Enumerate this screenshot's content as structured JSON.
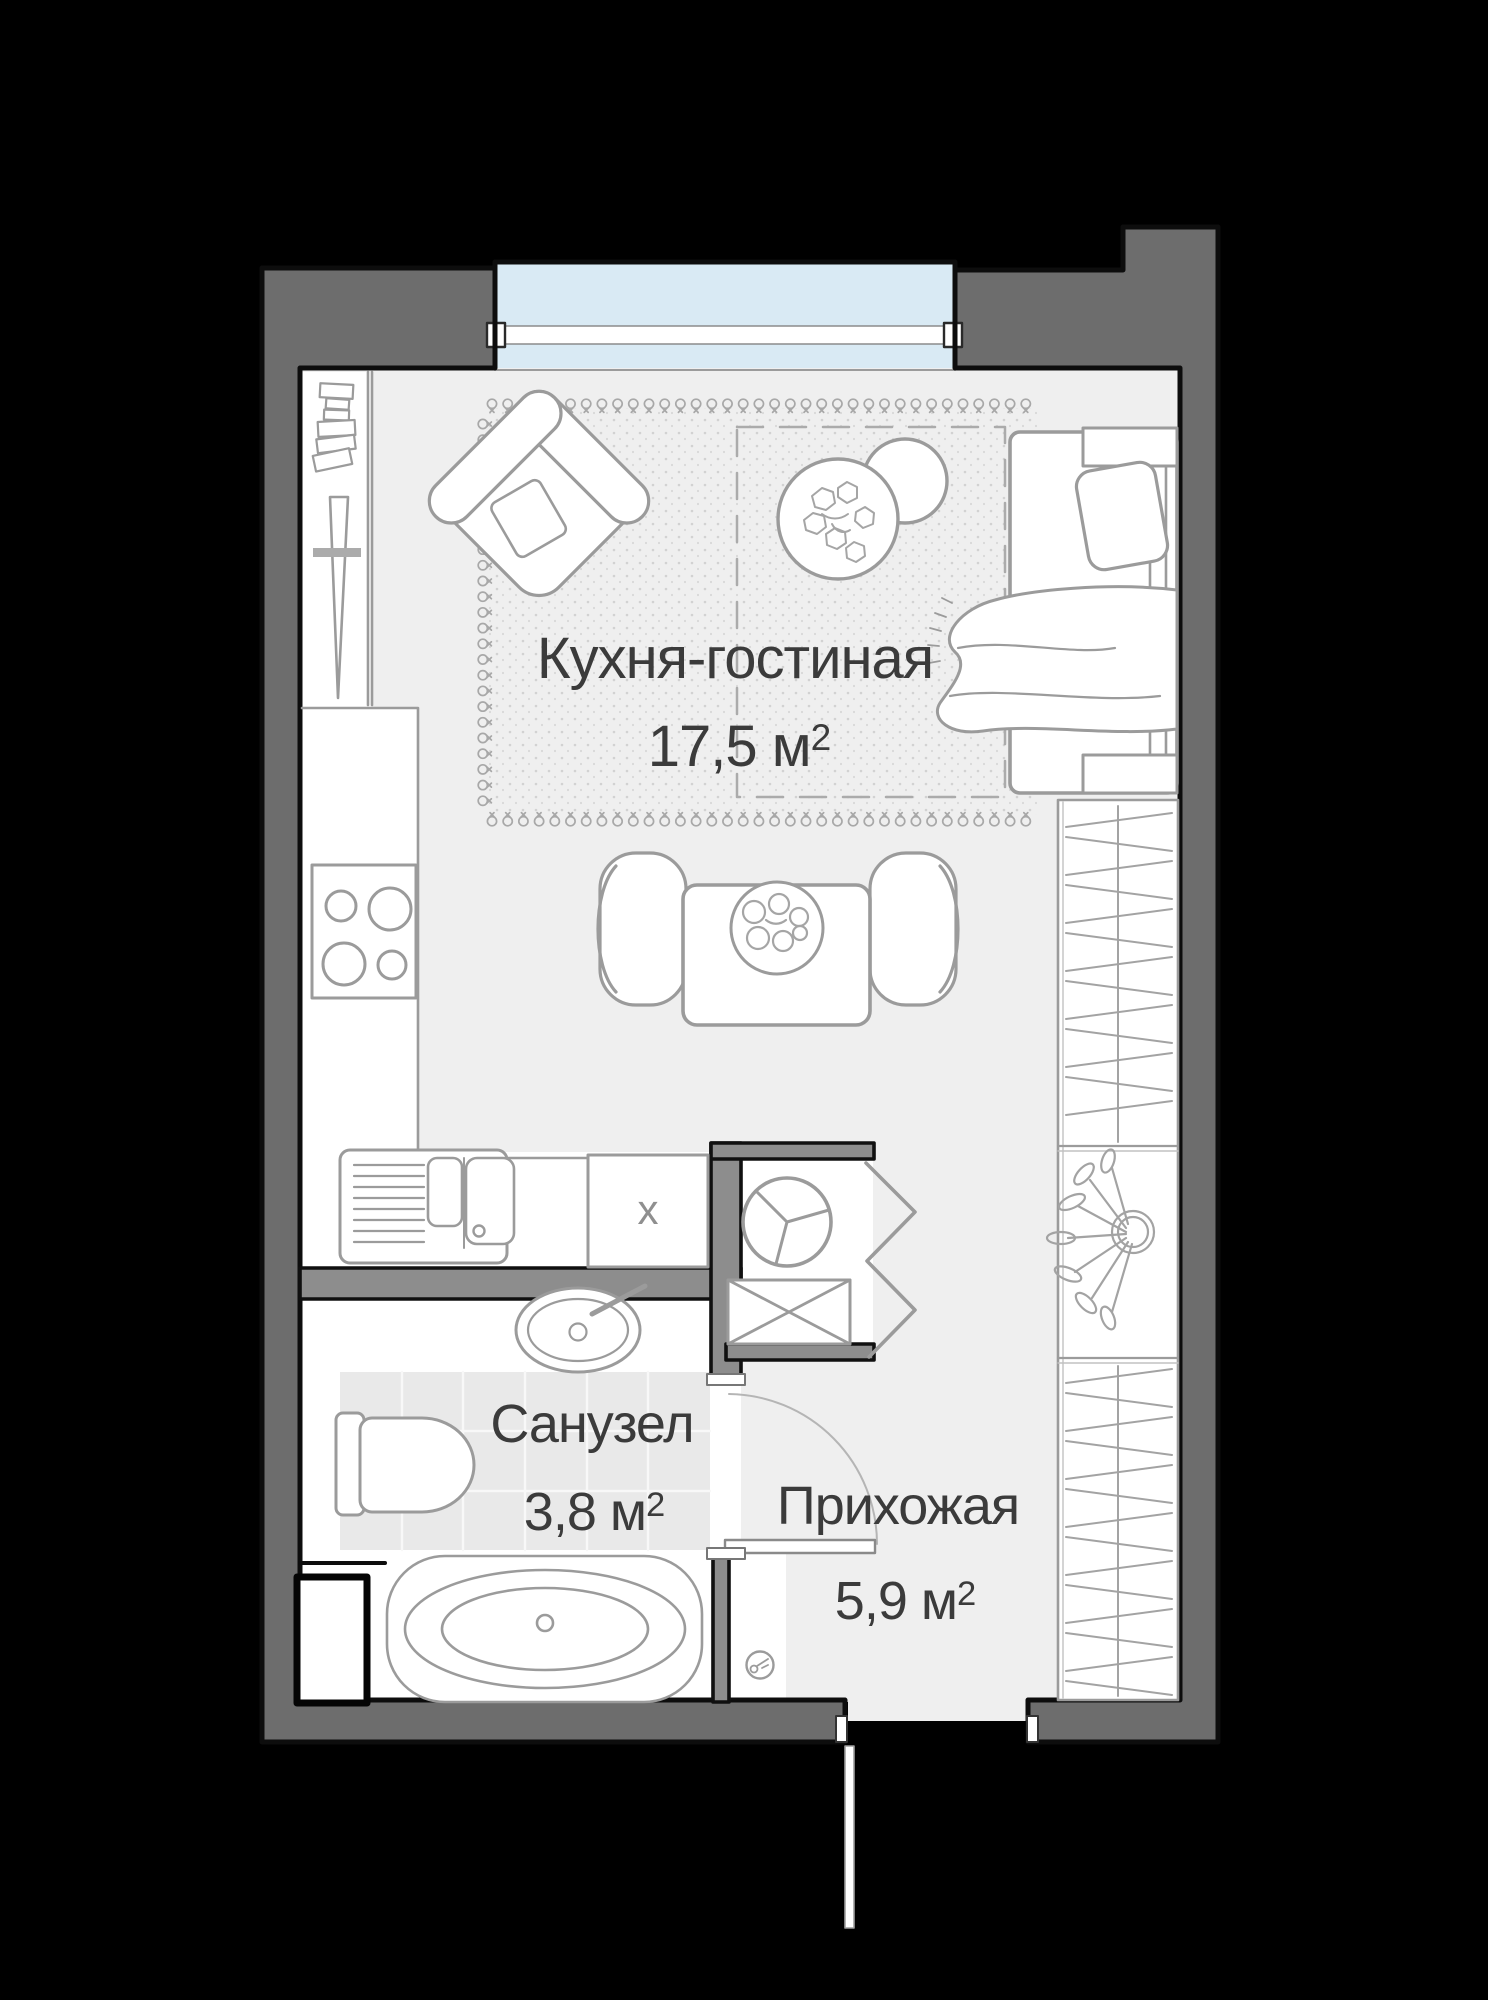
{
  "plan": {
    "kind": "apartment floor plan (studio)",
    "language": "ru"
  },
  "rooms": [
    {
      "id": "kitchen-living",
      "name": "Кухня-гостиная",
      "area": "17,5 м²",
      "area_value": "17,5 м",
      "area_sup": "2"
    },
    {
      "id": "bathroom",
      "name": "Санузел",
      "area": "3,8 м²",
      "area_value": "3,8 м",
      "area_sup": "2"
    },
    {
      "id": "hallway",
      "name": "Прихожая",
      "area": "5,9 м²",
      "area_value": "5,9 м",
      "area_sup": "2"
    }
  ],
  "markers": {
    "appliance": "x"
  },
  "colors": {
    "background": "#000000",
    "outer_wall": "#6d6d6d",
    "inner_wall": "#8d8d8d",
    "wall_outline": "#0d0d0d",
    "floor": "#efefef",
    "interior_white": "#ffffff",
    "furniture_stroke": "#9b9b9b",
    "window_glass": "#d9eaf4",
    "tile_floor": "#e9e9e9",
    "label_text": "#3b3b3b"
  }
}
